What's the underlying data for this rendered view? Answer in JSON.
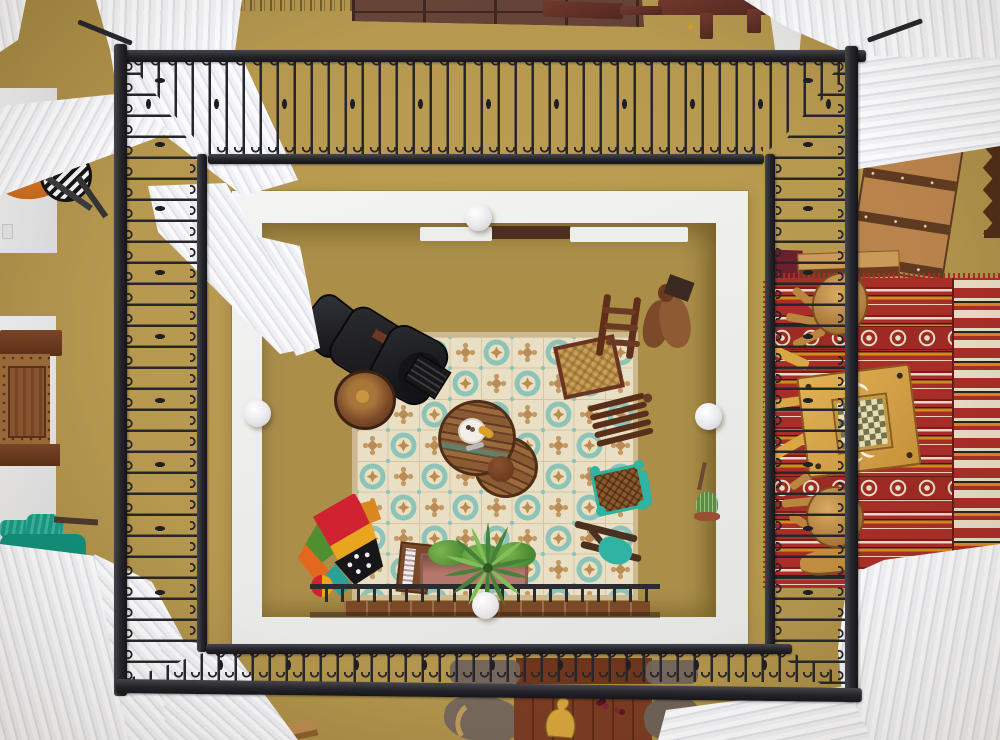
{
  "meta": {
    "type": "photograph",
    "width_px": 1000,
    "height_px": 740,
    "description": "Overhead view straight down into a colonial courtyard light-well: ochre balcony walkways with black wrought-iron railings surround a white plaster opening with globe lamps; white curtains fan across all four corners; below is a patterned cement-tile patio with a black chair, round reclaimed-wood tables, wooden and turquoise chairs, a patchwork pouf, a planter with palms, and on the right walkway a red striped kilim rug with a yellow games table and wooden stools."
  },
  "palette": {
    "ochre": "#b6984f",
    "ochre-deep": "#9f8440",
    "ochre-inner": "#ab8f49",
    "frame-white": "#eef0ee",
    "curtain": "#f4f4f7",
    "curtain-shade": "#e1e2e8",
    "iron": "#26262c",
    "iron-hi": "#46464e",
    "tile-cream": "#e9dfc4",
    "tile-teal": "#8cc4ba",
    "tile-tan": "#b98c55",
    "tile-border": "#cdb88f",
    "rug-red": "#a82e28",
    "rug-dark": "#7c1e1a",
    "rug-cream": "#e7dcc4",
    "rug-orange": "#d8881d",
    "rug-black": "#2c2020",
    "wood-dark": "#5f3a22",
    "wood-red": "#7a3b22",
    "wood-mid": "#8a5a33",
    "wood-tan": "#bb8a4f",
    "wood-yellow": "#d9a845",
    "leather": "#1b1b1f",
    "teal-bright": "#2fb3a2",
    "teal-velvet": "#129c86",
    "orange-velvet": "#c96a1e",
    "pink": "#d6336e",
    "green": "#4d8a33",
    "green-light": "#7ab54e",
    "terracotta": "#b5766b",
    "suede": "#71645a",
    "statue": "#7c4a28",
    "plate": "#f2efe8"
  },
  "scene": {
    "objects": [
      "balcony-walkway-floor",
      "railing-top",
      "railing-left",
      "railing-right",
      "railing-bottom",
      "corner-curtain-top-left",
      "corner-curtain-top-right",
      "corner-curtain-bottom-left",
      "corner-curtain-bottom-right",
      "courtyard-white-frame",
      "globe-lamp-top",
      "globe-lamp-left",
      "globe-lamp-right",
      "globe-lamp-bottom",
      "patio-tile-floor",
      "black-leather-chair",
      "round-wood-stool",
      "round-plank-table-large",
      "round-plank-table-small",
      "white-plate",
      "ladder-back-chair",
      "rocking-chair-slats",
      "turquoise-wicker-chair",
      "tipped-turquoise-chair",
      "patchwork-pouf",
      "magazine-rack",
      "terracotta-planter",
      "palm-plant",
      "wood-screen",
      "carved-statue",
      "cactus-pot",
      "kilim-rug",
      "games-table-checkerboard",
      "wood-stool-upper",
      "wood-stool-lower",
      "wood-trunk",
      "zigzag-shelf-bracket",
      "carved-cabinet",
      "orange-velvet-chair",
      "teal-velvet-bench",
      "brown-floor-tiles",
      "wood-bench-top",
      "lower-table-with-carved-duck",
      "suede-chairs"
    ]
  }
}
